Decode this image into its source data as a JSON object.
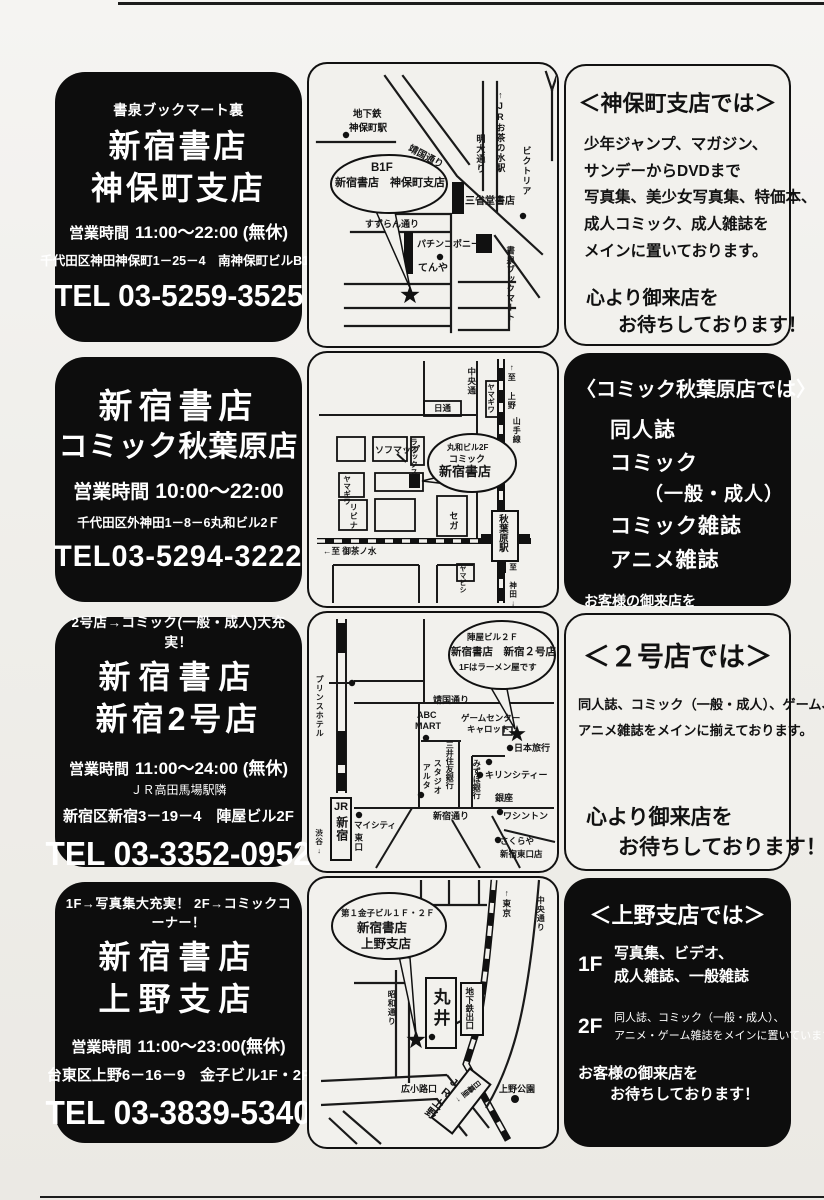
{
  "rows": [
    {
      "store": {
        "tagline": "書泉ブックマート裏",
        "name1": "新宿書店",
        "name2": "神保町支店",
        "hours_label": "営業時間",
        "hours": "11:00～22:00 (無休)",
        "address": "千代田区神田神保町1－25－4　南神保町ビルB1F",
        "tel": "TEL 03-5259-3525"
      },
      "map": {
        "subway1": "地下鉄",
        "subway2": "神保町駅",
        "yasukuni": "靖国通り",
        "meidai": "明大通り",
        "ochanomizu": "↑JRお茶の水駅",
        "victoria": "ビクトリア",
        "balloon1": "B1F",
        "balloon2": "新宿書店　神保町支店",
        "sanseido": "三省堂書店",
        "suzuran": "すずらん通り",
        "pachinko": "パチンコポニー",
        "tenya": "てんや",
        "shosen": "書泉ブックマート"
      },
      "info": {
        "title": "＜神保町支店では＞",
        "lines": [
          "少年ジャンプ、マガジン、",
          "サンデーからDVDまで",
          "写真集、美少女写真集、特価本、",
          "成人コミック、成人雑誌を",
          "メインに置いております。"
        ],
        "closing1": "心より御来店を",
        "closing2": "お待ちしております！"
      }
    },
    {
      "store": {
        "name1": "新宿書店",
        "name2": "コミック秋葉原店",
        "hours_label": "営業時間",
        "hours": "10:00～22:00",
        "address": "千代田区外神田1－8－6丸和ビル2Ｆ",
        "tel": "TEL03-5294-3222"
      },
      "map": {
        "chuo": "中央通",
        "yamagiwa1": "ヤマギワ",
        "nittsu": "日通",
        "ueno_dir": "↑至 上野",
        "yamanote": "山手線",
        "sofmap": "ソフマップ",
        "laox": "ラオックス",
        "balloon1": "丸和ビル2F",
        "balloon2": "コミック",
        "balloon3": "新宿書店",
        "yamagiwa2": "ヤマギワ",
        "livina": "リビナ",
        "sega": "セガ",
        "station": "秋葉原駅",
        "ochanomizu_dir": "←至 御茶ノ水",
        "yamabishi": "ヤマビシ",
        "kanda_dir": "至 神田↓"
      },
      "info": {
        "title": "〈コミック秋葉原店では〉",
        "items": [
          "同人誌",
          "コミック",
          "（一般・成人）",
          "コミック雑誌",
          "アニメ雑誌"
        ],
        "closing1": "お客様の御来店を",
        "closing2": "お待ちしております！"
      }
    },
    {
      "store": {
        "tagline": "2号店→コミック(一般・成人)大充実！",
        "name1": "新宿書店",
        "name2": "新宿2号店",
        "hours_label": "営業時間",
        "hours": "11:00～24:00 (無休)",
        "note": "ＪＲ高田馬場駅隣",
        "address": "新宿区新宿3－19－4　陣屋ビル2F",
        "tel": "TEL 03-3352-0952"
      },
      "map": {
        "balloon1": "陣屋ビル２Ｆ",
        "balloon2": "新宿書店　新宿２号店",
        "balloon3": "1Fはラーメン屋です",
        "prince": "プリンスホテル",
        "yasukuni": "靖国通り",
        "abc": "ABC",
        "mart": "MART",
        "game1": "ゲームセンター",
        "game2": "キャロット",
        "mitsui": "三井住友銀行",
        "nihon": "日本旅行",
        "mizuho": "みずほ銀行",
        "kirin": "キリンシティー",
        "studio": "スタジオ",
        "alta": "アルタ",
        "shinjuku_dori": "新宿通り",
        "ginza": "銀座",
        "washington": "ワシントン",
        "jr": "JR",
        "shinjuku": "新宿",
        "mycity": "マイシティ",
        "east_exit": "東口",
        "shibuya": "渋谷↓",
        "sakuraya1": "さくらや",
        "sakuraya2": "新宿東口店"
      },
      "info": {
        "title": "＜２号店では＞",
        "lines": [
          "同人誌、コミック（一般・成人）、ゲーム、",
          "アニメ雑誌をメインに揃えております。"
        ],
        "closing1": "心より御来店を",
        "closing2": "お待ちしております！"
      }
    },
    {
      "store": {
        "tagline": "1F→写真集大充実！ 2F→コミックコーナー！",
        "name1": "新宿書店",
        "name2": "上野支店",
        "hours_label": "営業時間",
        "hours": "11:00～23:00(無休)",
        "address": "台東区上野6－16－9　金子ビル1F・2F",
        "tel": "TEL 03-3839-5340"
      },
      "map": {
        "balloon1": "第１金子ビル１Ｆ・２Ｆ",
        "balloon2": "新宿書店",
        "balloon3": "上野支店",
        "tokyo_dir": "↑東京",
        "chuo": "中央通り",
        "showa": "昭和通り",
        "marui": "丸井",
        "subway_exit": "地下鉄出口",
        "hirokoji": "広小路口",
        "jr_ueno": "JR上野",
        "nippori": "日暮里→",
        "ueno_park": "上野公園"
      },
      "info": {
        "title": "＜上野支店では＞",
        "floor1_label": "1F",
        "floor1_lines": [
          "写真集、ビデオ、",
          "成人雑誌、一般雑誌"
        ],
        "floor2_label": "2F",
        "floor2_lines": [
          "同人誌、コミック（一般・成人）、",
          "アニメ・ゲーム雑誌をメインに置いています。"
        ],
        "closing1": "お客様の御来店を",
        "closing2": "お待ちしております！"
      }
    }
  ]
}
